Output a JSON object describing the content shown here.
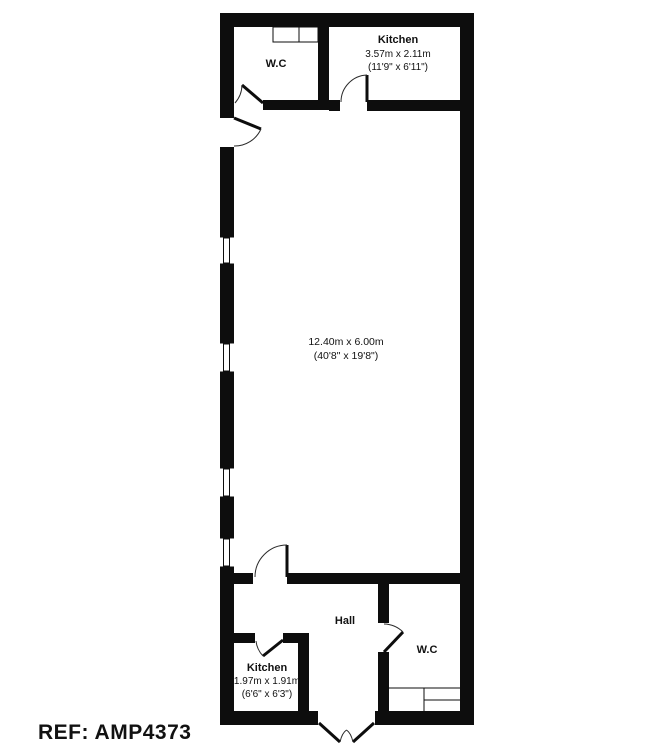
{
  "meta": {
    "background": "#ffffff",
    "wall_color": "#0d0d0d",
    "ref_color": "#2c3848"
  },
  "rooms": {
    "wc_top": {
      "label": "W.C"
    },
    "kitchen_top": {
      "name": "Kitchen",
      "metric": "3.57m x 2.11m",
      "imperial": "(11'9\" x 6'11\")"
    },
    "main_room": {
      "metric": "12.40m x 6.00m",
      "imperial": "(40'8\" x 19'8\")"
    },
    "hall": {
      "label": "Hall"
    },
    "kitchen_bottom": {
      "name": "Kitchen",
      "metric": "1.97m x 1.91m",
      "imperial": "(6'6\" x 6'3\")"
    },
    "wc_bottom": {
      "label": "W.C"
    }
  },
  "reference": {
    "text": "REF: AMP4373"
  }
}
